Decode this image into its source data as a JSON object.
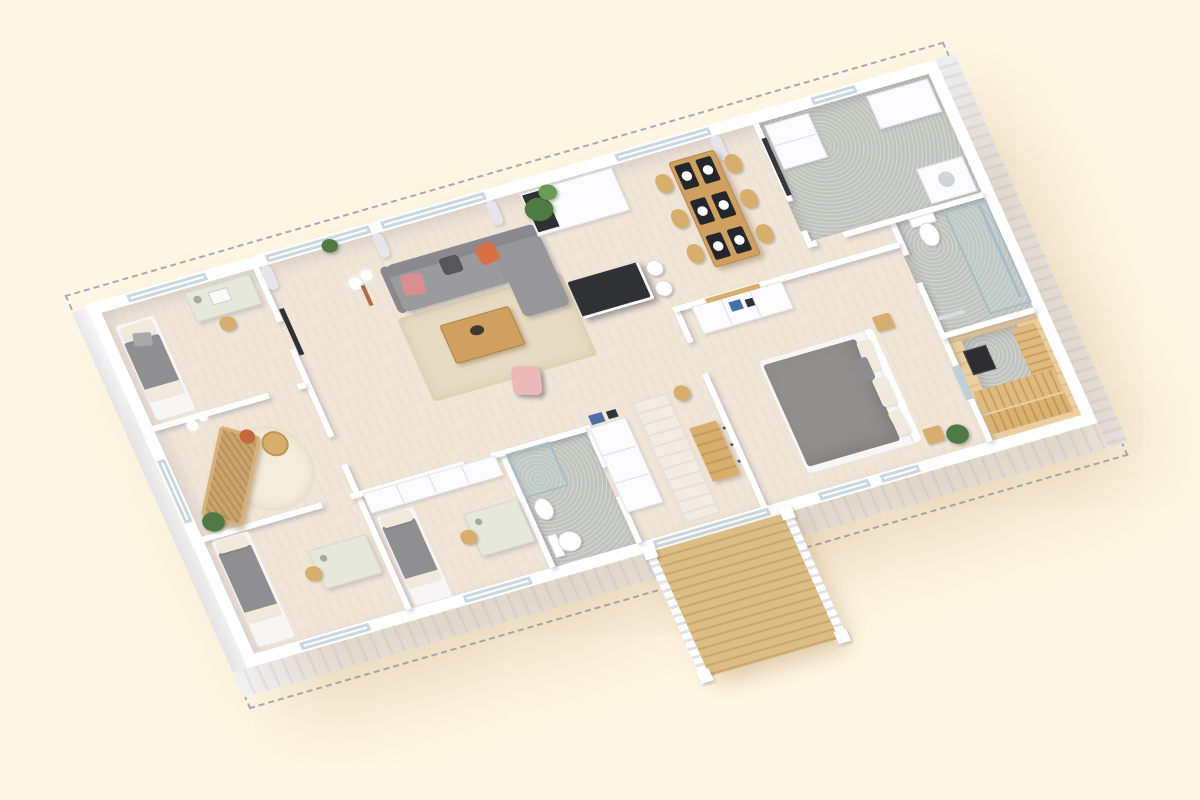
{
  "scene": {
    "type": "isometric-3d-floor-plan-rendering",
    "rooms": [
      "living-room",
      "kitchen",
      "dining-area",
      "utility-room",
      "master-bedroom",
      "bedroom-desk",
      "lounge-room",
      "kids-bedroom-a",
      "kids-bedroom-b",
      "bathroom-main",
      "bathroom-small",
      "sauna",
      "hallway",
      "deck"
    ],
    "has_text": false
  },
  "palette": {
    "bg": "#FFF7E5",
    "wall": "#FFFFFF",
    "face": "#F2F3F7",
    "dash": "#9AA0AA",
    "floorWood": "#F0E5D7",
    "tile": "#C2C5BE",
    "glass": "#C9D8DF",
    "curtain": "#E6E6EA",
    "sofa": "#9B9A9E",
    "sofaDark": "#8A8A8E",
    "cushionPink": "#D98F8F",
    "cushionOrange": "#D96F45",
    "cushionDark": "#55555A",
    "rug": "#E7DCC3",
    "rugRound": "#F2ECDC",
    "woodMid": "#CFA05F",
    "woodChair": "#D8AE6E",
    "rattan": "#C9A46B",
    "chairPink": "#EDB9B8",
    "bedGray": "#8F8F91",
    "duvetMaster": "#918F8B",
    "linen": "#F0EADC",
    "plant": "#4F7A44",
    "plantLight": "#6C9A58",
    "counterDark": "#2F3134",
    "saunaWall": "#EBCFA0",
    "saunaBench": "#E0B97E",
    "deck": "#DCBD85",
    "deckGap": "#C9A869",
    "blueBox": "#4A6FA5",
    "terracotta": "#C4693F",
    "copper": "#B06A4A",
    "white": "#FBFBFD",
    "steel": "#A8BCC6"
  }
}
